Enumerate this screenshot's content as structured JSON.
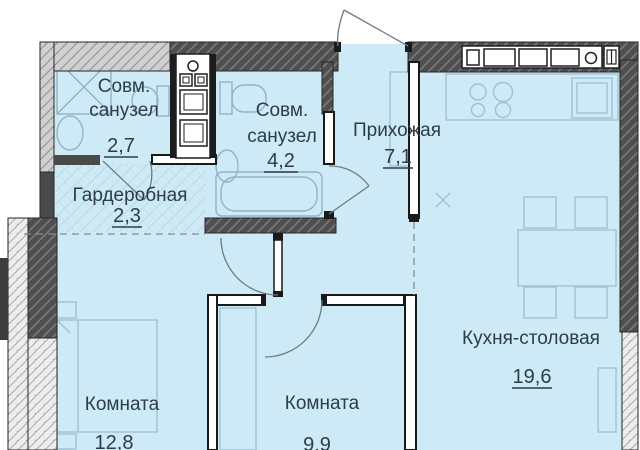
{
  "plan": {
    "type": "apartment-floor-plan",
    "rooms": [
      {
        "id": "bathroom-1",
        "label_lines": [
          "Совм.",
          "санузел"
        ],
        "area": "2,7"
      },
      {
        "id": "bathroom-2",
        "label_lines": [
          "Совм.",
          "санузел"
        ],
        "area": "4,2"
      },
      {
        "id": "hallway",
        "label_lines": [
          "Прихожая"
        ],
        "area": "7,1"
      },
      {
        "id": "wardrobe",
        "label_lines": [
          "Гардеробная"
        ],
        "area": "2,3"
      },
      {
        "id": "room-1",
        "label_lines": [
          "Комната"
        ],
        "area": "12,8"
      },
      {
        "id": "room-2",
        "label_lines": [
          "Комната"
        ],
        "area": "9,9"
      },
      {
        "id": "kitchen-dining",
        "label_lines": [
          "Кухня-столовая"
        ],
        "area": "19,6"
      }
    ],
    "symbols": [
      "entrance-door",
      "shower",
      "sink",
      "toilet",
      "bathtub",
      "washer-column",
      "vent-shaft",
      "kitchen-counter",
      "stove-burners",
      "fridge",
      "dining-table",
      "chairs",
      "bed",
      "wardrobe-shelves",
      "floor-mark-x"
    ],
    "colors": {
      "room_fill": "#cdeaf6",
      "wall_dark": "#4f4f4f",
      "wall_light": "#d0d0d0",
      "wall_light2": "#ededed",
      "furniture_line": "#9fc2d4",
      "text": "#2e3c49"
    }
  }
}
